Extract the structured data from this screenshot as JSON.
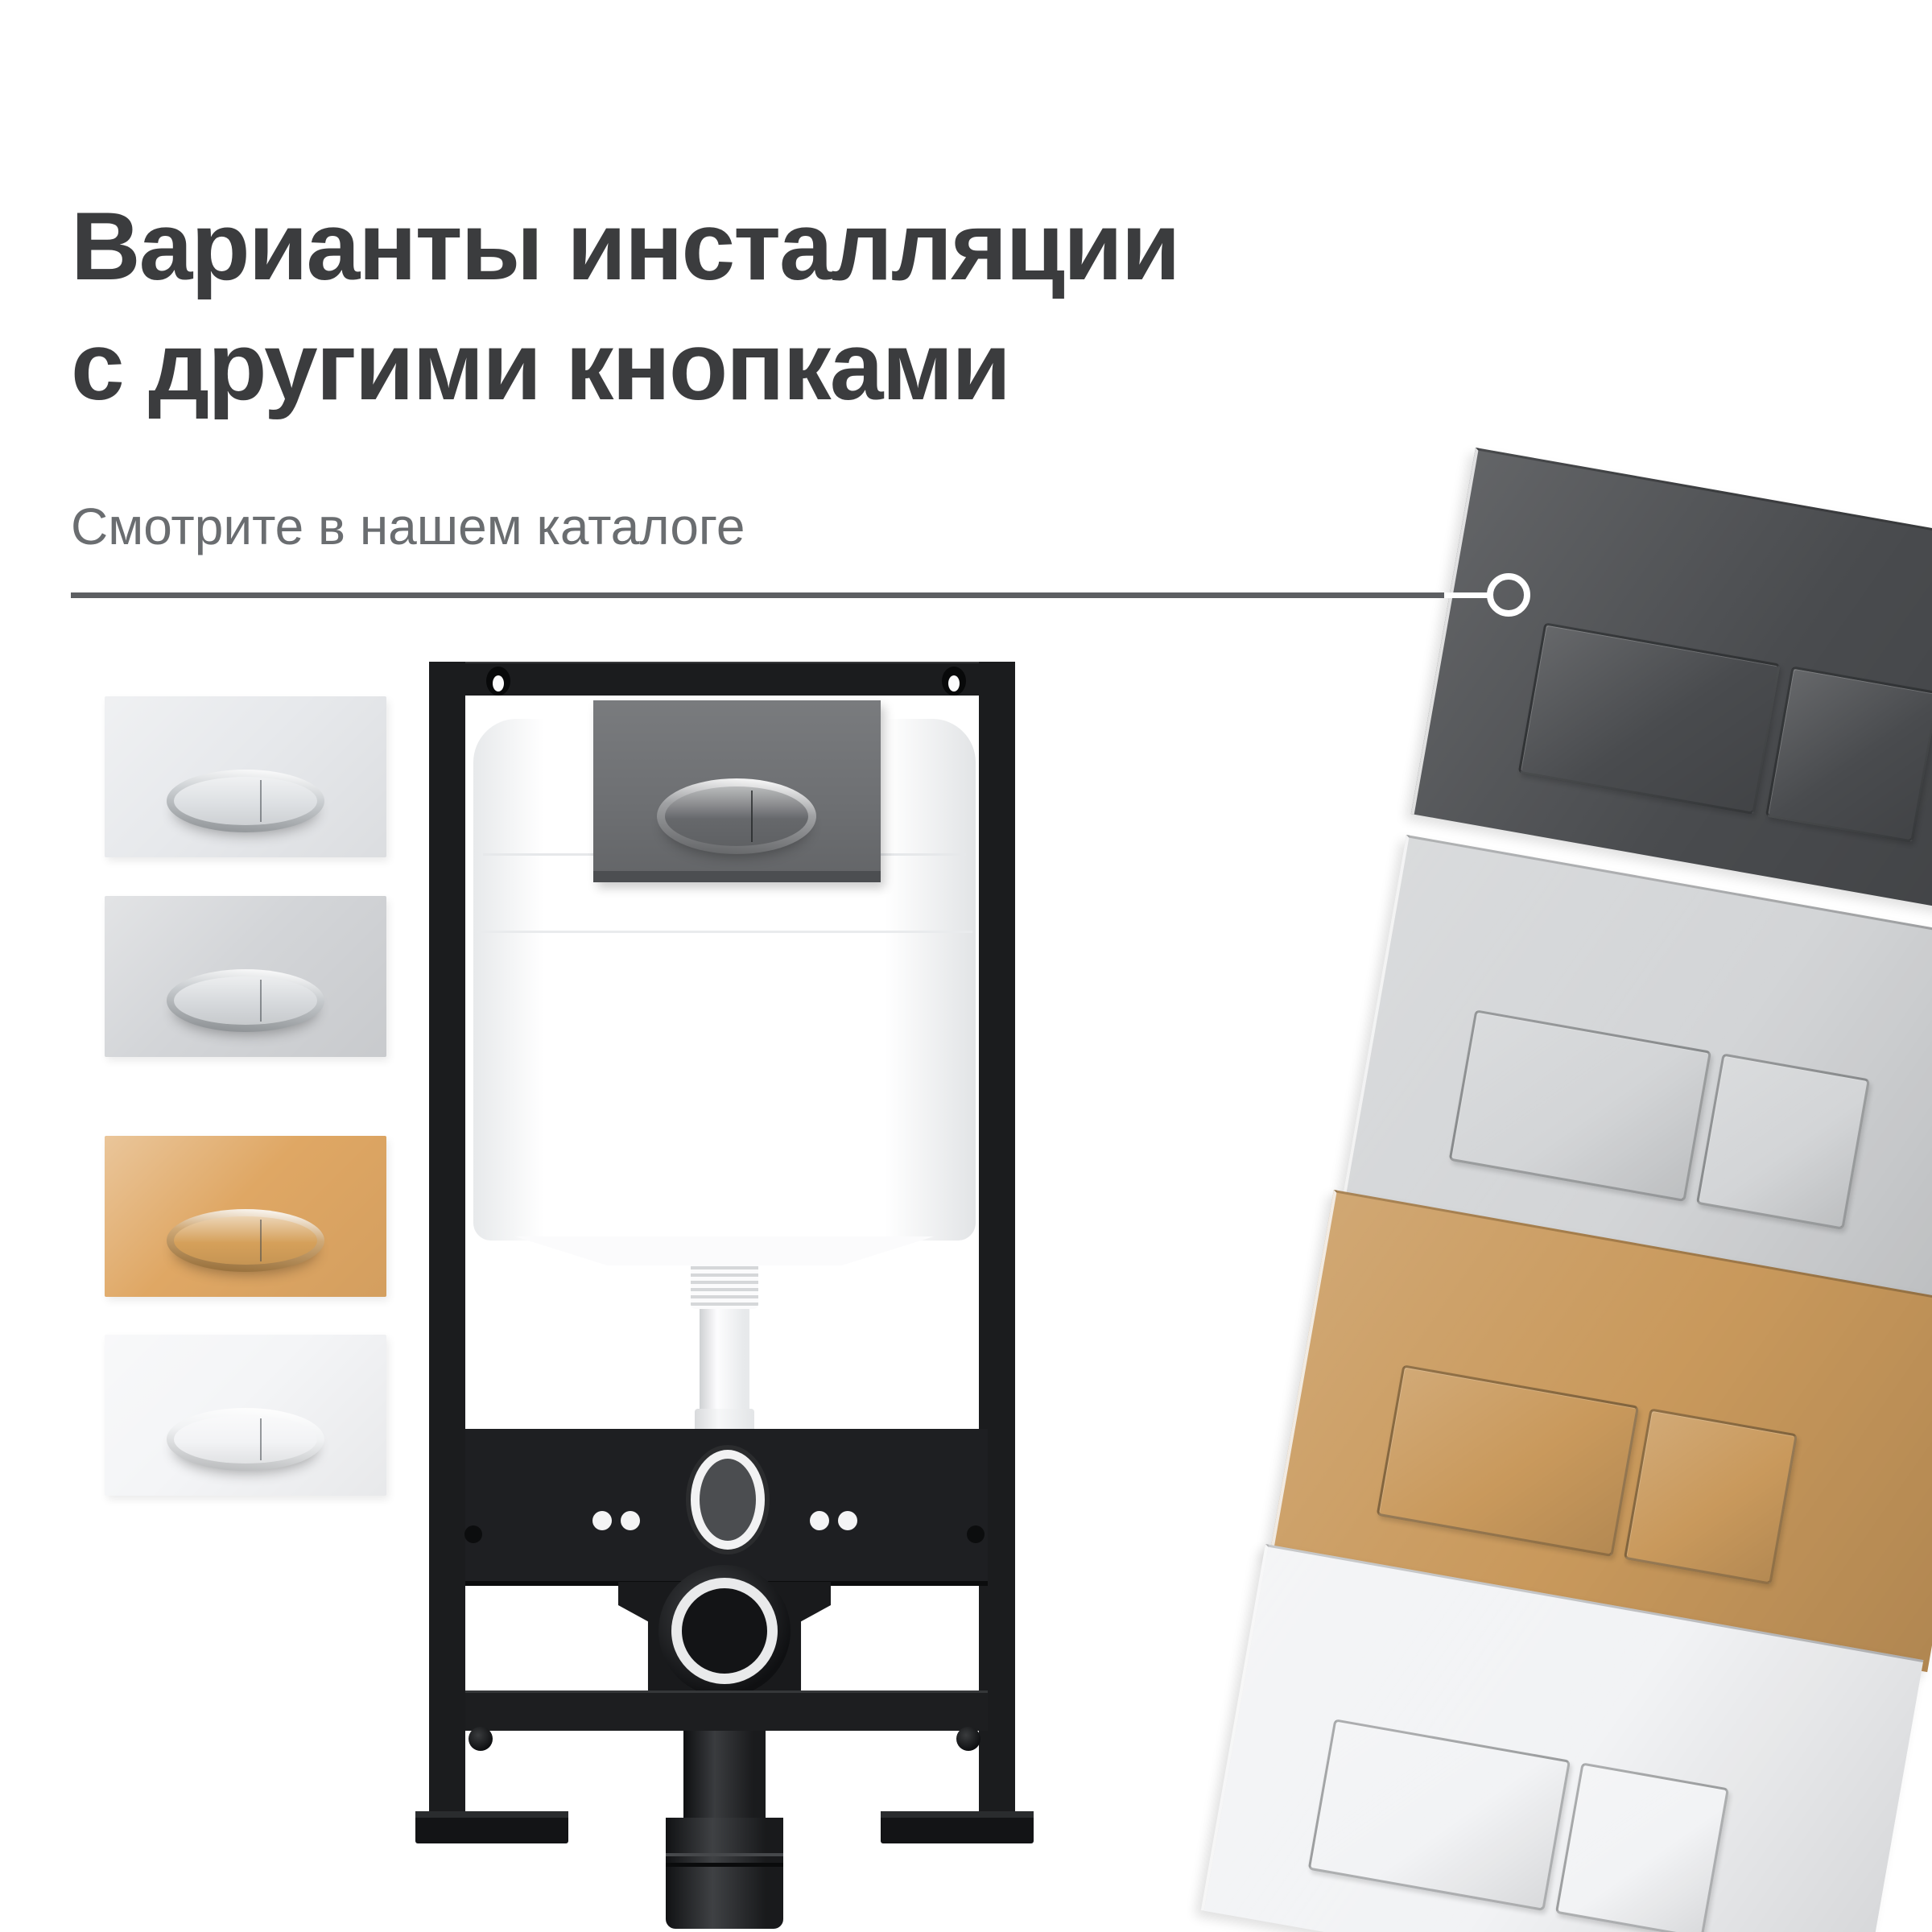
{
  "header": {
    "title_line1": "Варианты инсталляции",
    "title_line2": "с другими кнопками",
    "subtitle": "Смотрите в нашем каталоге",
    "title_color": "#3b3c3e",
    "subtitle_color": "#6a6d70"
  },
  "callout": {
    "line_color": "#5d5f62",
    "highlight_line_color": "#ffffff",
    "circle_color": "#ffffff"
  },
  "left_plates": [
    {
      "finish": "chrome-light",
      "plate_color": "#e7e9ec",
      "ring_color": "#b9bec2",
      "face_color": "#dde0e3"
    },
    {
      "finish": "chrome-gray",
      "plate_color": "#d3d5d8",
      "ring_color": "#b3b8bc",
      "face_color": "#d6d9dc"
    },
    {
      "finish": "brushed-gold",
      "plate_color": "#dfa764",
      "ring_color": "#c08d4a",
      "face_color": "#d5a05a"
    },
    {
      "finish": "matte-white",
      "plate_color": "#f4f5f7",
      "ring_color": "#eceef0",
      "face_color": "#f2f3f5"
    }
  ],
  "right_plates": [
    {
      "finish": "graphite",
      "plate_color": "#494b4e"
    },
    {
      "finish": "light-gray",
      "plate_color": "#d3d5d7"
    },
    {
      "finish": "brushed-gold",
      "plate_color": "#c9995c"
    },
    {
      "finish": "matte-white",
      "plate_color": "#f2f3f5"
    }
  ],
  "installation": {
    "frame_color": "#1b1c1e",
    "tank_color": "#ffffff",
    "mounted_plate_color": "#6e7073",
    "mounted_ring_color": "#808285",
    "mounted_face_color": "#66686b",
    "gasket_color": "#e9eaeb"
  }
}
